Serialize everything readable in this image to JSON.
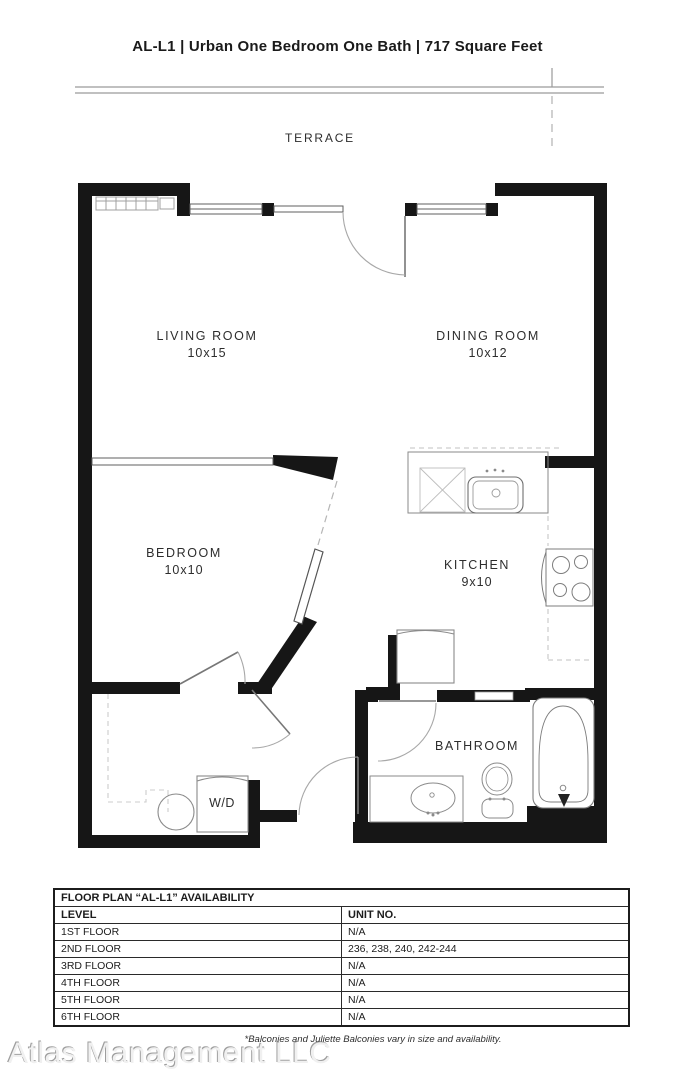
{
  "page": {
    "title": "AL-L1 | Urban One Bedroom One Bath | 717 Square Feet"
  },
  "floorplan": {
    "rooms": [
      {
        "id": "terrace",
        "name": "TERRACE",
        "dims": ""
      },
      {
        "id": "living",
        "name": "LIVING ROOM",
        "dims": "10x15"
      },
      {
        "id": "dining",
        "name": "DINING ROOM",
        "dims": "10x12"
      },
      {
        "id": "bedroom",
        "name": "BEDROOM",
        "dims": "10x10"
      },
      {
        "id": "kitchen",
        "name": "KITCHEN",
        "dims": "9x10"
      },
      {
        "id": "bathroom",
        "name": "BATHROOM",
        "dims": ""
      },
      {
        "id": "laundry",
        "name": "W/D",
        "dims": ""
      }
    ],
    "fixtures": [
      "baseboard-heater",
      "window",
      "terrace-door",
      "sliding-door",
      "dishwasher",
      "kitchen-sink",
      "stove",
      "refrigerator",
      "washer",
      "vanity-sink",
      "toilet",
      "bathtub"
    ]
  },
  "availability": {
    "title": "FLOOR PLAN “AL-L1” AVAILABILITY",
    "columns": [
      "LEVEL",
      "UNIT NO."
    ],
    "rows": [
      {
        "level": "1ST FLOOR",
        "units": "N/A"
      },
      {
        "level": "2ND FLOOR",
        "units": "236, 238, 240, 242-244"
      },
      {
        "level": "3RD FLOOR",
        "units": "N/A"
      },
      {
        "level": "4TH FLOOR",
        "units": "N/A"
      },
      {
        "level": "5TH FLOOR",
        "units": "N/A"
      },
      {
        "level": "6TH FLOOR",
        "units": "N/A"
      }
    ]
  },
  "footer": {
    "note": "*Balconies and Juliette Balconies vary in size and availability.",
    "watermark": "Atlas Management LLC"
  },
  "colors": {
    "wall": "#161616",
    "thin_line": "#6f6f6f",
    "fixture_line": "#8a8a8a",
    "dash_line": "#c2c2c2",
    "text": "#2d2d2d"
  }
}
